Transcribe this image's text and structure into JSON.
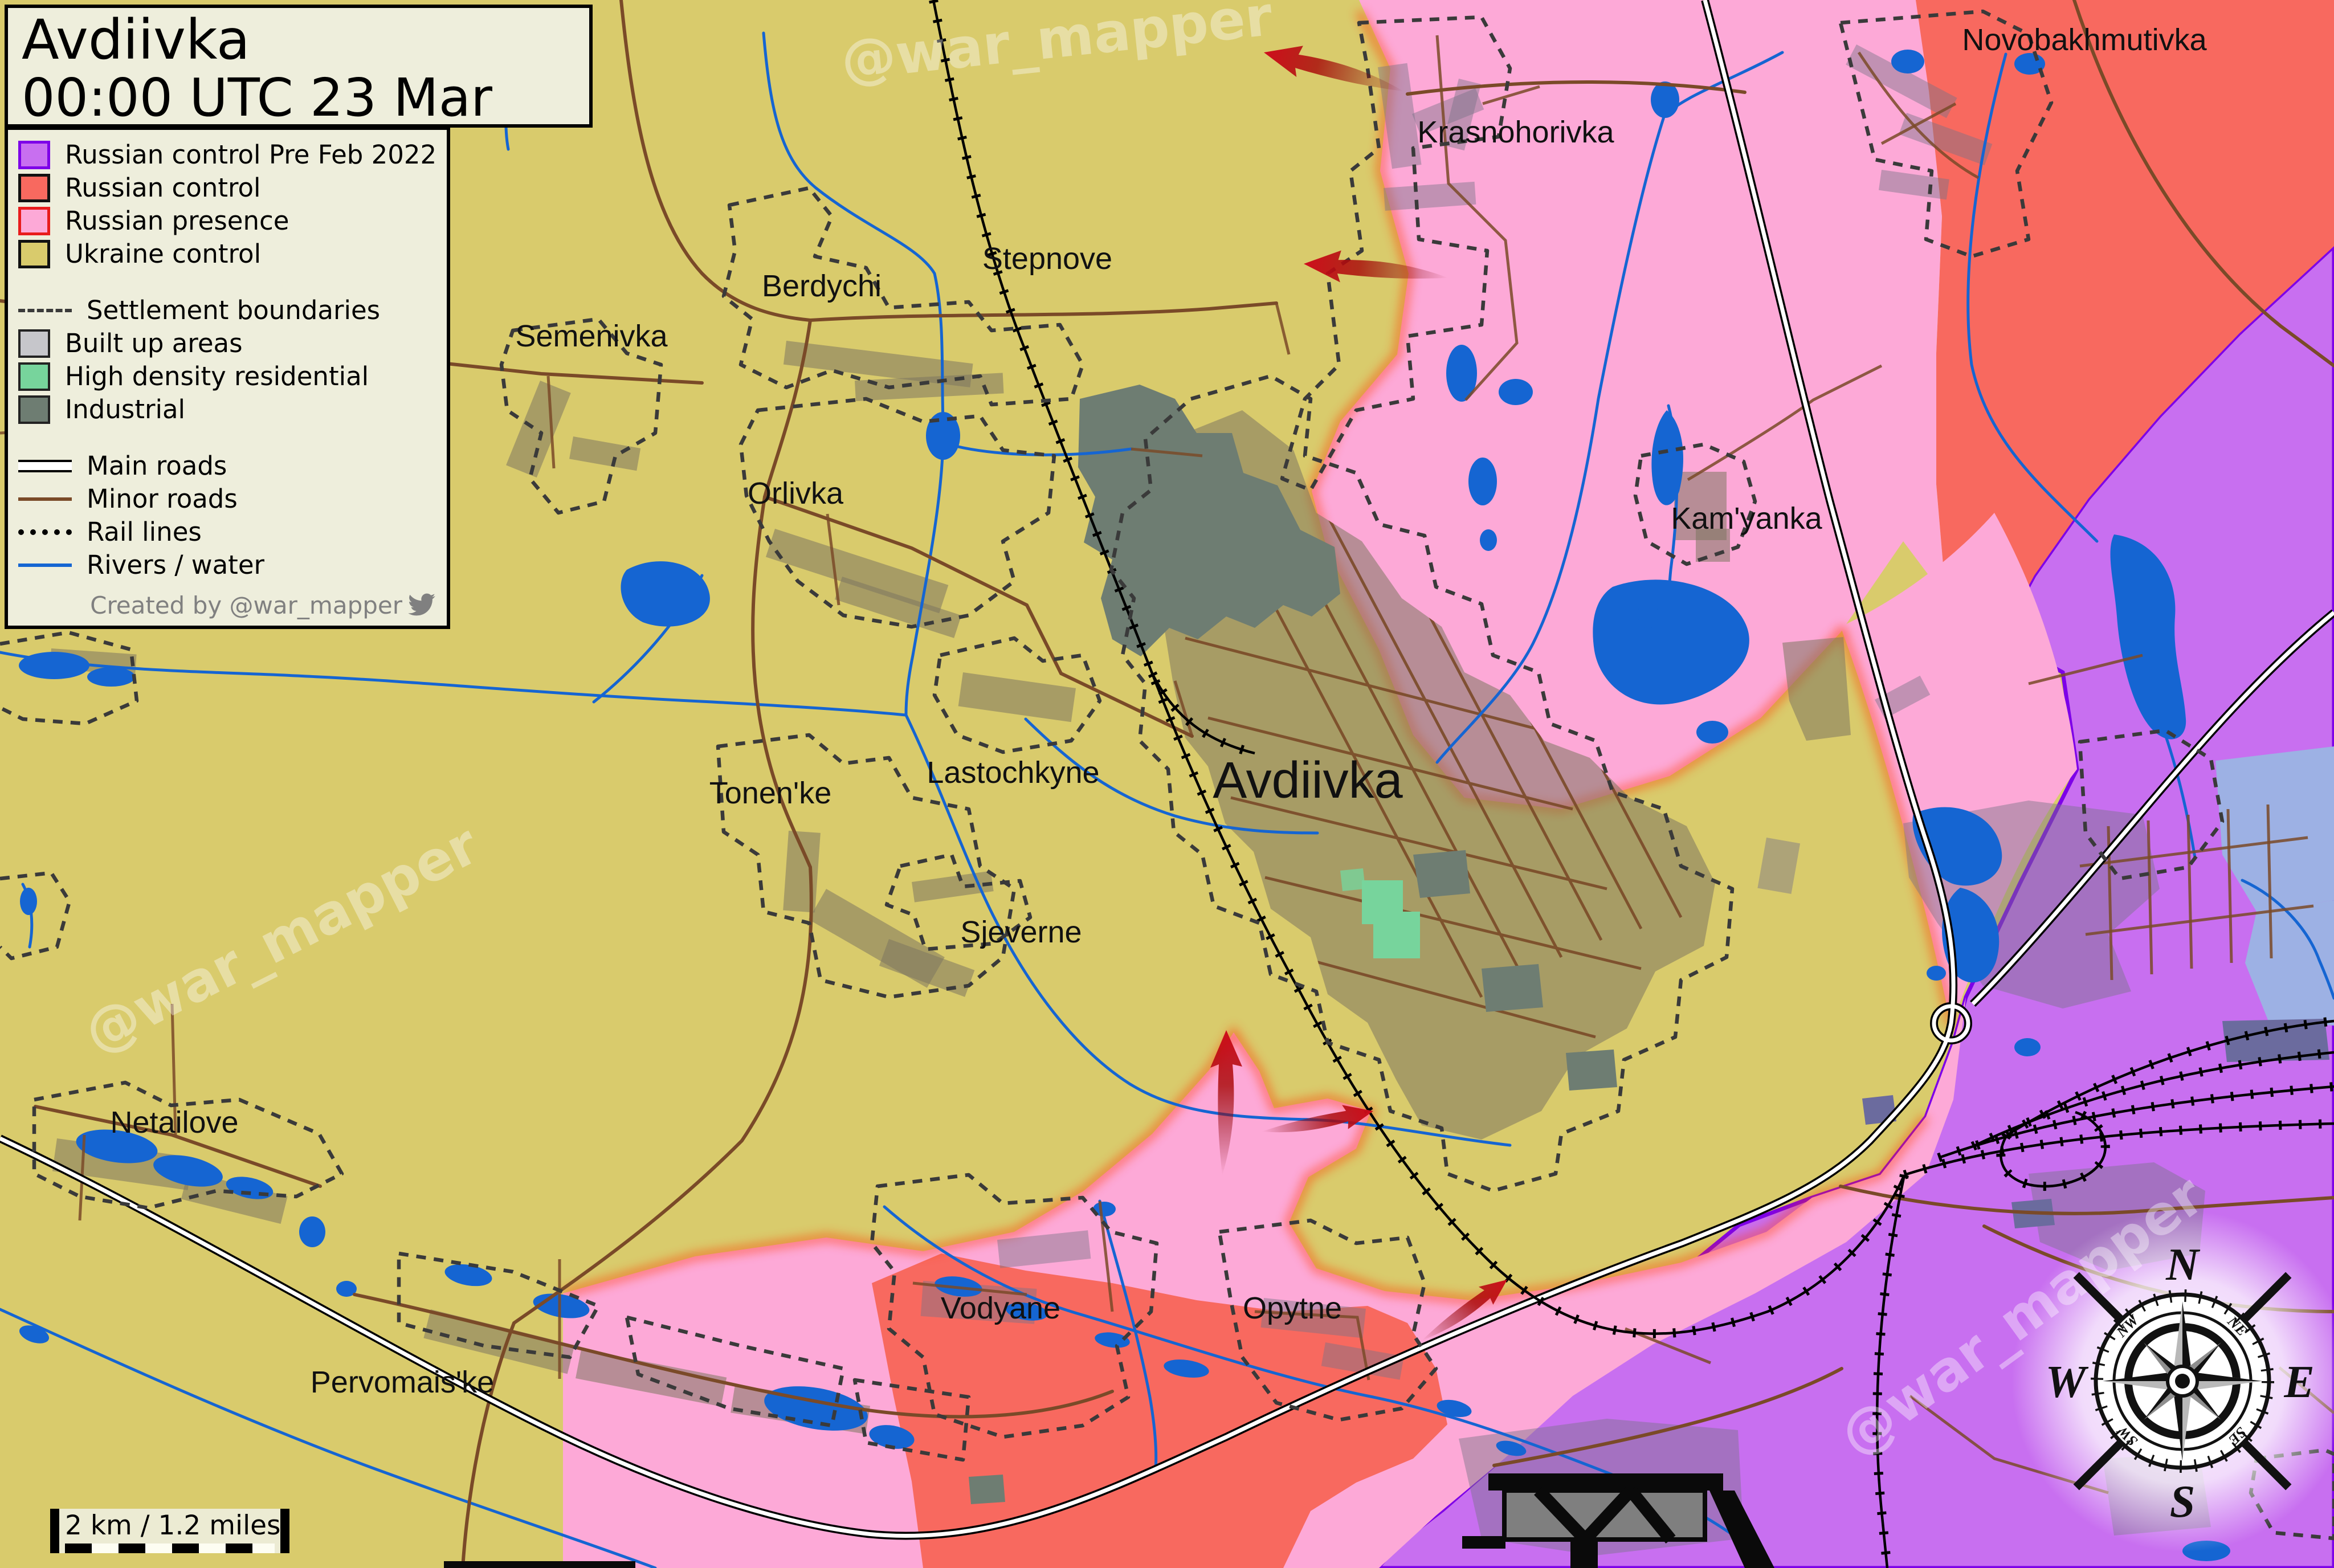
{
  "title": {
    "line1": "Avdiivka",
    "line2": "00:00 UTC 23 Mar 23"
  },
  "legend": {
    "areas": [
      {
        "label": "Russian control Pre Feb 2022"
      },
      {
        "label": "Russian control"
      },
      {
        "label": "Russian presence"
      },
      {
        "label": "Ukraine control"
      }
    ],
    "features": [
      {
        "label": "Settlement boundaries"
      },
      {
        "label": "Built up areas"
      },
      {
        "label": "High density residential"
      },
      {
        "label": "Industrial"
      }
    ],
    "lines": [
      {
        "label": "Main roads"
      },
      {
        "label": "Minor roads"
      },
      {
        "label": "Rail lines"
      },
      {
        "label": "Rivers / water"
      }
    ],
    "credit": "Created by @war_mapper"
  },
  "scalebar": {
    "text": "2 km / 1.2 miles"
  },
  "watermark": {
    "text": "@war_mapper"
  },
  "compass": {
    "n": "N",
    "e": "E",
    "s": "S",
    "w": "W",
    "ne": "NE",
    "se": "SE",
    "sw": "SW",
    "nw": "NW"
  },
  "places": [
    {
      "name": "Krasnohorivka"
    },
    {
      "name": "Novobakhmutivka"
    },
    {
      "name": "Berdychi"
    },
    {
      "name": "Stepnove"
    },
    {
      "name": "Semenivka"
    },
    {
      "name": "Orlivka"
    },
    {
      "name": "Kam'yanka"
    },
    {
      "name": "Lastochkyne"
    },
    {
      "name": "Avdiivka"
    },
    {
      "name": "Tonen'ke"
    },
    {
      "name": "Sjeverne"
    },
    {
      "name": "Netailove"
    },
    {
      "name": "Vodyane"
    },
    {
      "name": "Opytne"
    },
    {
      "name": "Pervomais'ke"
    }
  ],
  "colors": {
    "prefeb": "#c86ff0",
    "control": "#f8695f",
    "presence": "#fda9d7",
    "ukraine": "#d9cb6c",
    "water": "#1565d2",
    "res": "#77d49c",
    "industrial": "#6e7d72",
    "minor": "#7a4a28",
    "bnd": "#3a3a3a",
    "glow": "#ff3b00",
    "arrow": "#cf0d1c",
    "panel": "#eeeedc",
    "prefeb_border": "#7d00e8"
  }
}
